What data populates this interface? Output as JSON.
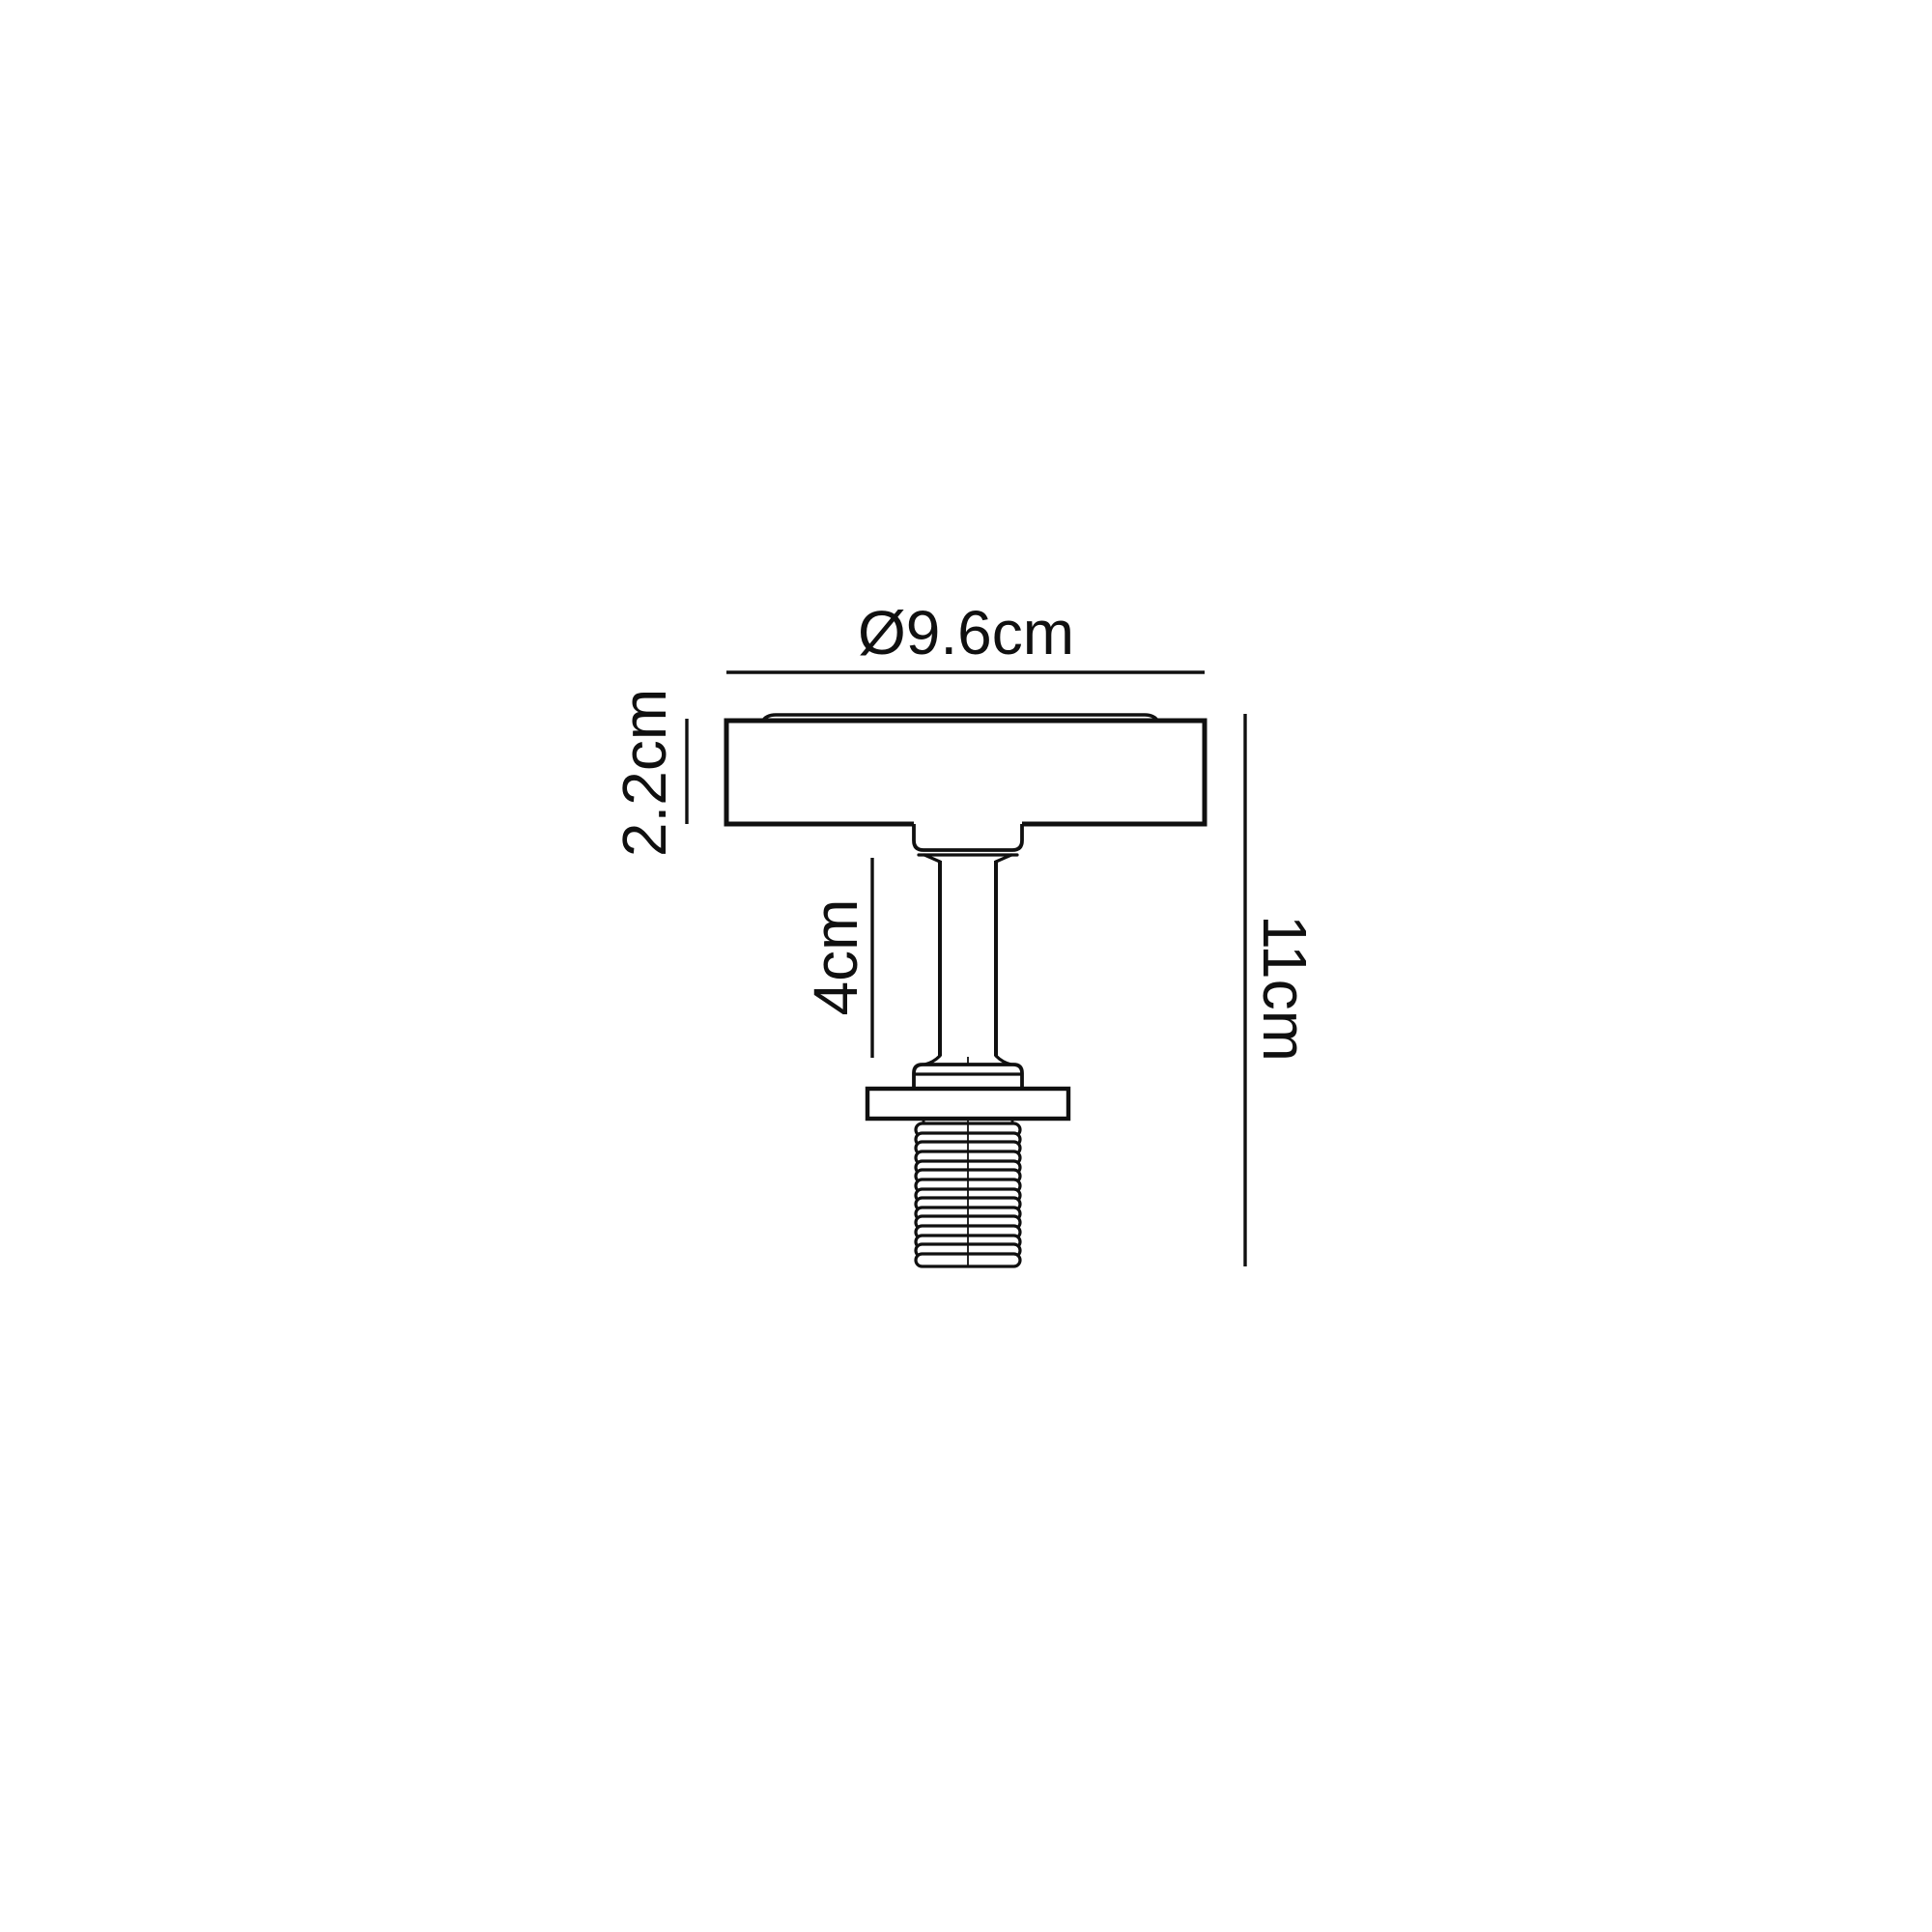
{
  "colors": {
    "background": "#ffffff",
    "line": "#101010"
  },
  "labels": {
    "diameter": "Ø9.6cm",
    "canopy_height": "2.2cm",
    "stem_length": "4cm",
    "overall_height": "11cm"
  }
}
